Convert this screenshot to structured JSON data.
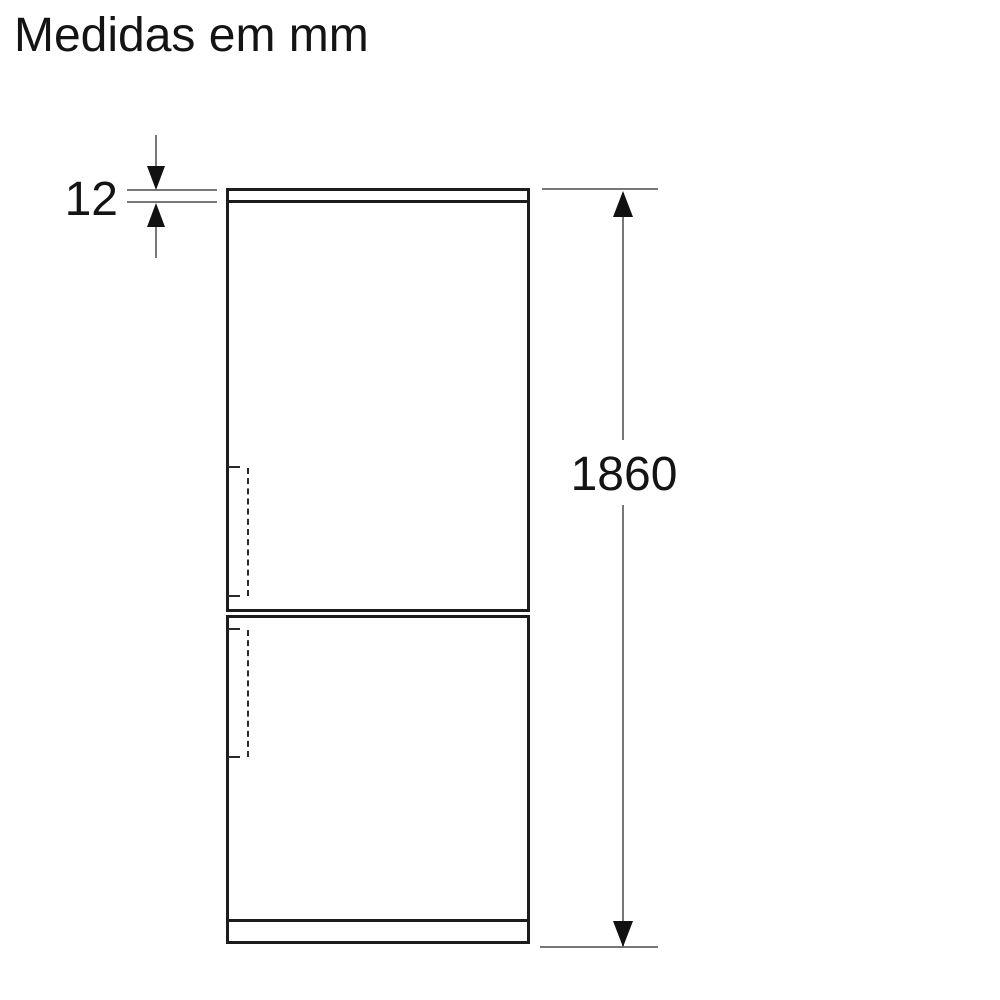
{
  "title": "Medidas em mm",
  "dimensions": {
    "top_panel_thickness": {
      "value": "12",
      "unit": "mm"
    },
    "overall_height": {
      "value": "1860",
      "unit": "mm"
    }
  },
  "colors": {
    "background": "#ffffff",
    "outline": "#1c1c1c",
    "dimension_line": "#777777",
    "arrow": "#111111",
    "hinge_dash": "#2a2a2a",
    "text": "#141414"
  }
}
